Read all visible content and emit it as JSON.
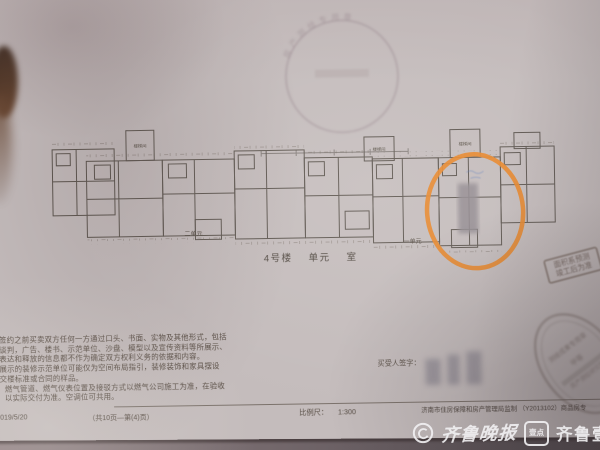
{
  "doc": {
    "building_no": "4号楼",
    "unit_word": "单元",
    "room_word": "室",
    "plan_labels": {
      "stair": "楼梯间",
      "unit1": "一单元",
      "unit2": "二单元"
    },
    "disclaimer_lines": [
      "签约之前买卖双方任何一方通过口头、书面、实物及其他形式，包括",
      "谈判，广告、楼书、示范单位、沙盘、模型以及宣传资料等所展示、",
      "表达和释放的信息都不作为确定双方权利义务的依据和内容。",
      "展示的装修示范单位可能仅为空间布局指引，装修装饰和家具摆设",
      "交楼标准或合同的样品。",
      "燃气管道、燃气仪表位置及接驳方式以燃气公司施工为准，在验收",
      "以实际交付为准。空调位可共用。"
    ],
    "buyer_signature_label": "买受人签字：",
    "footer": {
      "date": "2019/5/20",
      "pages": "（共10页—第(4)页）",
      "scale_label": "比例尺：",
      "scale_value": "1:300",
      "publisher": "济南市住房保障和房产管理局监制 （Y2013102）商品房专"
    },
    "stamps": {
      "round_arc_text": "房产测绘专用章",
      "note_line1": "面积系预测",
      "note_line2": "竣工后为准",
      "oval_line1": "测绘成果专用章",
      "oval_line2": "甲等",
      "oval_line3": "房产测绘研究院"
    },
    "highlight_color": "#e6862b"
  },
  "watermark": {
    "news_name": "齐鲁晚报",
    "brand_name": "齐鲁壹点",
    "logo_glyph": "壹点"
  }
}
